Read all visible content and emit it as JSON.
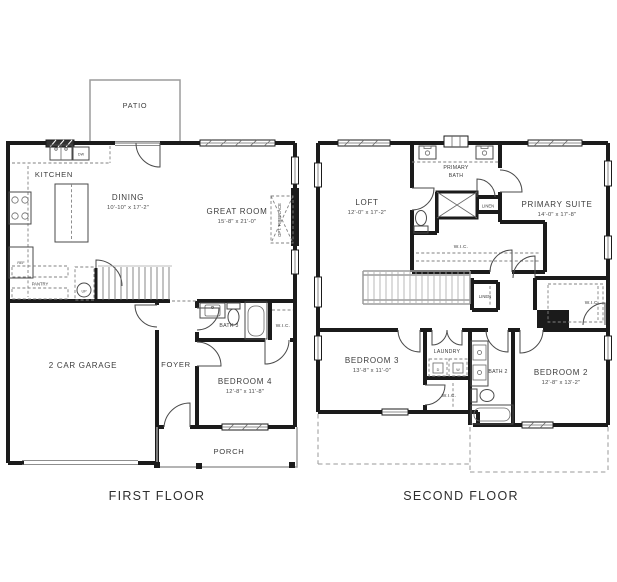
{
  "colors": {
    "wall": "#1b1b1b",
    "thin_line": "#4a4a4a",
    "gray_line": "#9c9c9c",
    "dashed_line": "#828282",
    "background": "#ffffff"
  },
  "first_floor": {
    "caption": "FIRST FLOOR",
    "patio": "PATIO",
    "kitchen": "KITCHEN",
    "dining_name": "DINING",
    "dining_dims": "10'-10\" x 17'-2\"",
    "great_room_name": "GREAT ROOM",
    "great_room_dims": "15'-8\" x 21'-0\"",
    "opt_fireplace": "OPT. FIREPLACE",
    "pantry": "PANTRY",
    "ref": "REF",
    "dw": "DW",
    "stairs_up": "UP",
    "foyer": "FOYER",
    "bath3": "BATH 3",
    "wic_bedroom4": "W.I.C.",
    "bedroom4_name": "BEDROOM 4",
    "bedroom4_dims": "12'-8\" x 11'-8\"",
    "garage": "2 CAR GARAGE",
    "porch": "PORCH"
  },
  "second_floor": {
    "caption": "SECOND FLOOR",
    "loft_name": "LOFT",
    "loft_dims": "12'-0\" x 17'-2\"",
    "primary_bath_line1": "PRIMARY",
    "primary_bath_line2": "BATH",
    "linen_upper": "LINEN",
    "linen_lower": "LINEN",
    "primary_suite_name": "PRIMARY SUITE",
    "primary_suite_dims": "14'-0\" x 17'-8\"",
    "wic_primary": "W.I.C.",
    "wic_bedroom2": "W.I.C.",
    "wic_bedroom3": "W.I.C.",
    "bedroom3_name": "BEDROOM 3",
    "bedroom3_dims": "13'-8\" x 11'-0\"",
    "laundry": "LAUNDRY",
    "dryer": "D",
    "washer": "W",
    "bath2": "BATH 2",
    "bedroom2_name": "BEDROOM 2",
    "bedroom2_dims": "12'-8\" x 13'-2\""
  }
}
